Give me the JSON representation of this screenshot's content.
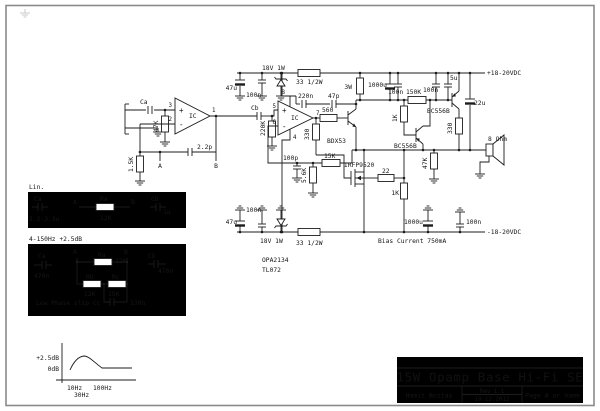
{
  "s1": {
    "ca": "Ca",
    "rin": "47K",
    "ic": "IC",
    "p3": "3",
    "p2": "2",
    "p1": "1",
    "plus": "+",
    "minus": "-",
    "cfb": "2.2p",
    "rg": "1.5K",
    "a": "A",
    "b": "B"
  },
  "s2": {
    "cb": "Cb",
    "rin": "220K",
    "ic": "IC",
    "p5": "5",
    "p6": "6",
    "p7": "7",
    "p8": "8",
    "p4": "4",
    "plus": "+",
    "minus": "-",
    "ccomp": "100p",
    "rfb": "15K",
    "rg": "5.6K"
  },
  "pt": {
    "c1": "47u",
    "c2": "100n",
    "dz": "18V 1W",
    "r": "33 1/2W",
    "rail": "+18-20VDC"
  },
  "pb": {
    "c1": "47u",
    "c2": "100n",
    "dz": "18V 1W",
    "r": "33 1/2W",
    "rail": "-18-20VDC"
  },
  "drv": {
    "c220n": "220n",
    "c47p": "47p",
    "r560": "560",
    "r330": "330",
    "q": "BDX53",
    "fet": "IRFP9520",
    "r22": "22",
    "r1k": "1K"
  },
  "bias": {
    "r3w": "3W",
    "c1000u": "1000u",
    "c100n_a": "100n",
    "r150k": "150K",
    "r1k": "1K",
    "c100n_b": "100n",
    "c5u": "5u",
    "q_top": "BC556B",
    "q_bot": "BC556B",
    "r330": "330",
    "r47k": "47K",
    "c22u": "22u",
    "note": "Bias Current 750mA"
  },
  "out": {
    "spk": "8 Ohm",
    "c1000u": "1000u",
    "c100n": "100n"
  },
  "ics": {
    "a": "OPA2134",
    "b": "TL072"
  },
  "lin": {
    "title": "Lin.",
    "ca": "Ca",
    "ca_v": "2.2-3.3u",
    "a": "A",
    "ra": "Ra",
    "ra_v": "12K",
    "b": "B",
    "cb": "Cb",
    "cb_v": "1u"
  },
  "eq": {
    "title": "4-150Hz  +2.5dB",
    "a": "A",
    "b": "B",
    "ca": "Ca",
    "ca_v": "470n",
    "ra": "Ra",
    "ra_v": "22K",
    "rb": "Rb",
    "rb_v": "12K",
    "rc": "Rc",
    "rc_v": "15K",
    "cc": "Cc",
    "cc_v": "330n",
    "cb": "Cb",
    "cb_v": "470n",
    "note": "Low Phase slip"
  },
  "graph": {
    "y1": "+2.5dB",
    "y0": "0dB",
    "x1": "10Hz",
    "x2": "100Hz",
    "xp": "30Hz"
  },
  "tb": {
    "title": "15W Opamp Base Hi-Fi SE",
    "author": "Hamit Boztas",
    "rev": "Rev 1.1",
    "date": "19.12.2012",
    "page": "Page # or name"
  },
  "chart_data": {
    "type": "line",
    "title": "Bass EQ response (4-150Hz network)",
    "xlabel": "Frequency",
    "ylabel": "Level (dB)",
    "x_tick_labels": [
      "10Hz",
      "30Hz",
      "100Hz"
    ],
    "y_tick_labels": [
      "0dB",
      "+2.5dB"
    ],
    "points": [
      {
        "hz": 10,
        "db": 0
      },
      {
        "hz": 30,
        "db": 2.5
      },
      {
        "hz": 100,
        "db": 0
      },
      {
        "hz": 300,
        "db": 0
      }
    ],
    "ylim": [
      -0.5,
      3
    ]
  }
}
